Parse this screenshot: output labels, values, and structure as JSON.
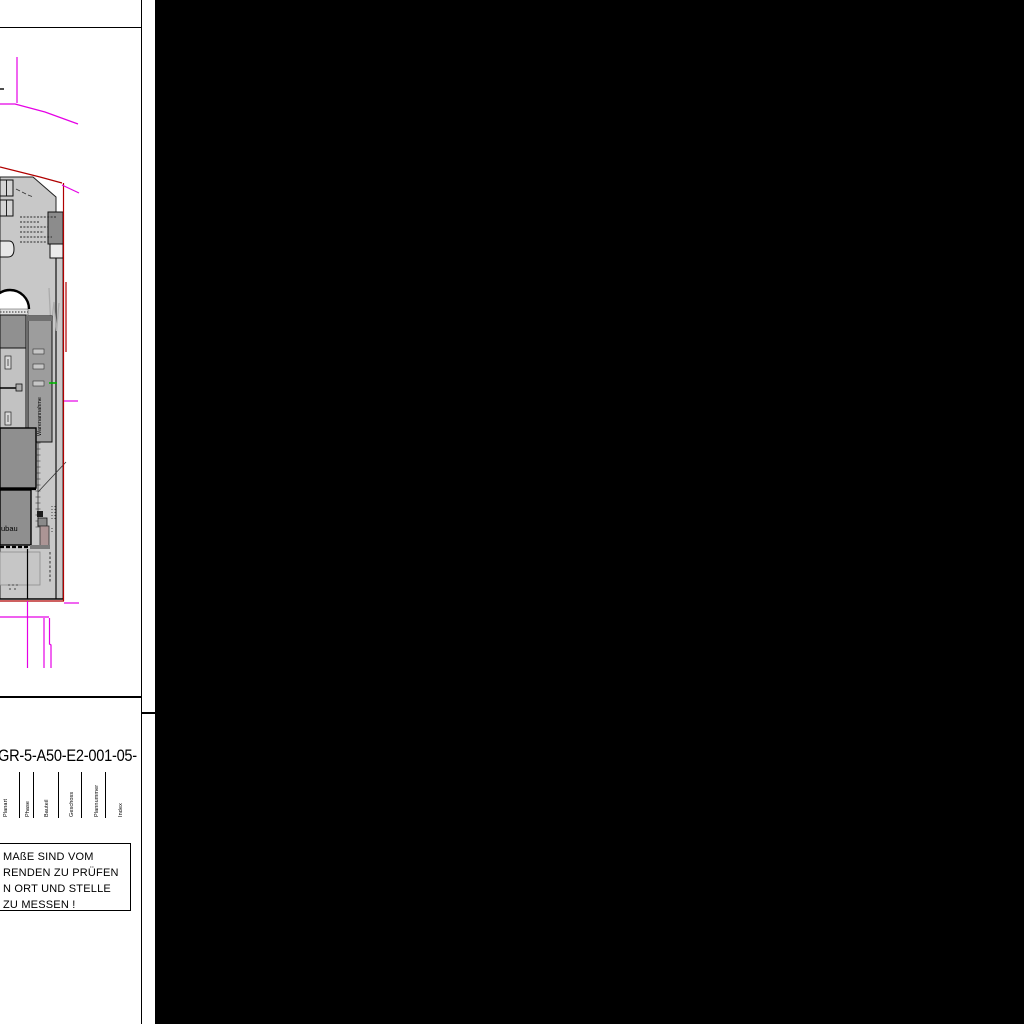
{
  "sheet": {
    "drawing_number": "GR-5-A50-E2-001-05-",
    "title_block_fields": [
      "Planart",
      "Phase",
      "Bauteil",
      "Geschoss",
      "Plannummer",
      "Index"
    ],
    "note_lines": [
      "MAßE SIND VOM",
      "RENDEN ZU PRÜFEN",
      "N ORT UND STELLE",
      "ZU MESSEN !"
    ]
  },
  "plan": {
    "corridor_label": "Warenannahme",
    "building_label_fragment": "ubau",
    "colors": {
      "boundary_red": "#b00000",
      "parcel_magenta": "#e500e5",
      "highlight_green": "#00b800",
      "plan_gray_light": "#c8c8c8",
      "plan_gray_dark": "#8f8f8f",
      "viewport_background": "#000000"
    }
  }
}
